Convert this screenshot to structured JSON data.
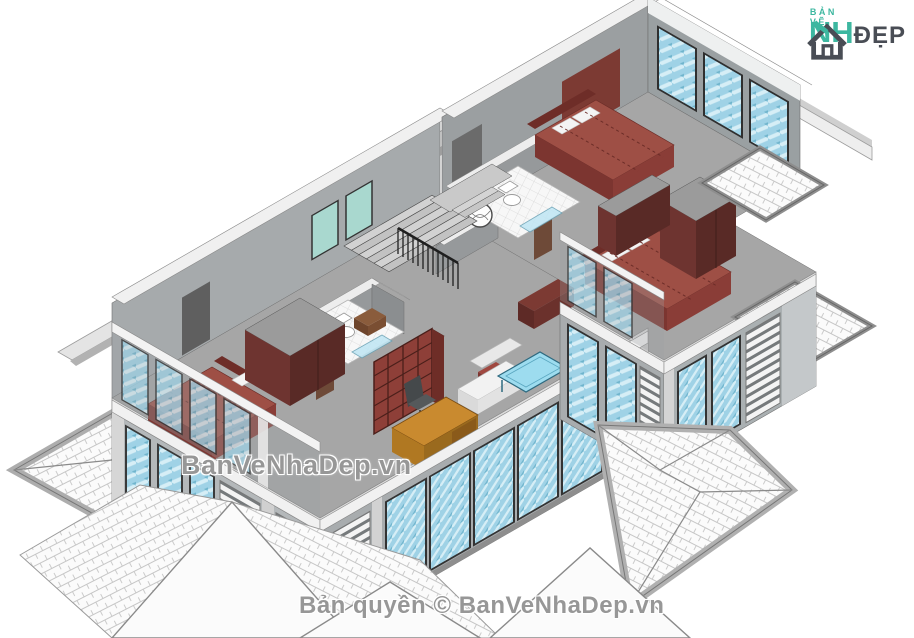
{
  "canvas": {
    "width": 914,
    "height": 638,
    "background": "#ffffff"
  },
  "logo": {
    "tagline": "BẢN VẼ",
    "word_left": "NH",
    "word_right": "ĐẸP",
    "teal": "#3db7a0",
    "dark": "#494d55",
    "icon": "house-icon"
  },
  "watermarks": {
    "center": "BanVeNhaDep.vn",
    "bottom": "Bản quyền © BanVeNhaDep.vn"
  },
  "scene": {
    "type": "isometric-architectural-render",
    "subject": "Villa second-floor cutaway plan, Revit-style 3D view",
    "palette": {
      "floor_gray": "#a6a6a6",
      "wall_light": "#c2c6c8",
      "wall_inner": "#95999b",
      "wall_cap_white": "#f1f1f1",
      "bed_red": "#9e4f45",
      "bed_red_dark": "#7c3530",
      "wardrobe_maroon": "#6e3430",
      "glass_blue": "#9fd2e6",
      "roof_tile": "#fbfbfb",
      "roof_edge": "#b0b0b0",
      "desk_wood": "#c98a2f",
      "vanity_brown": "#8a5c3c",
      "watermark_gray": "#808080"
    },
    "rooms": [
      "bedroom-top",
      "bedroom-right",
      "bedroom-left",
      "bathroom-top",
      "bathroom-center",
      "stair-hall",
      "study",
      "roof-terraces"
    ],
    "objects": [
      "hip roofs with shingle tiles",
      "three double beds with dashed mattress seams",
      "maroon wardrobes",
      "two bathrooms with toilet, round basket tub and glass shower",
      "U-shaped staircase with dark balustrade",
      "red bookshelf",
      "wood desk with office chair",
      "white sofa",
      "blue glass coffee table",
      "glazed curtain walls with louver balconies",
      "paved roof terraces"
    ]
  }
}
